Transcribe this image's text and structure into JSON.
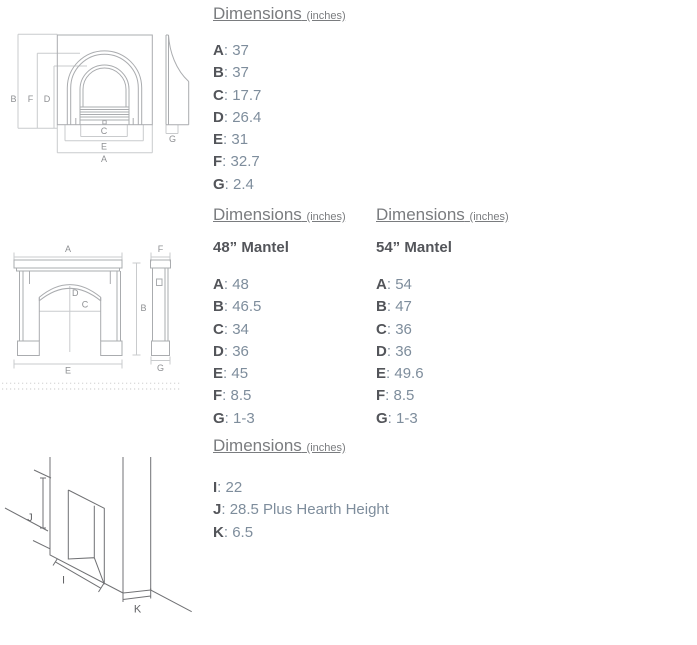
{
  "punct": {
    "colon": ": "
  },
  "headings": {
    "dimensions_title": "Dimensions",
    "dimensions_unit": "(inches)"
  },
  "insert": {
    "dims": [
      {
        "label": "A",
        "value": "37"
      },
      {
        "label": "B",
        "value": "37"
      },
      {
        "label": "C",
        "value": "17.7"
      },
      {
        "label": "D",
        "value": "26.4"
      },
      {
        "label": "E",
        "value": "31"
      },
      {
        "label": "F",
        "value": "32.7"
      },
      {
        "label": "G",
        "value": "2.4"
      }
    ]
  },
  "mantel48": {
    "subtitle": "48” Mantel",
    "dims": [
      {
        "label": "A",
        "value": "48"
      },
      {
        "label": "B",
        "value": "46.5"
      },
      {
        "label": "C",
        "value": "34"
      },
      {
        "label": "D",
        "value": "36"
      },
      {
        "label": "E",
        "value": "45"
      },
      {
        "label": "F",
        "value": "8.5"
      },
      {
        "label": "G",
        "value": "1-3"
      }
    ]
  },
  "mantel54": {
    "subtitle": "54” Mantel",
    "dims": [
      {
        "label": "A",
        "value": "54"
      },
      {
        "label": "B",
        "value": "47"
      },
      {
        "label": "C",
        "value": "36"
      },
      {
        "label": "D",
        "value": "36"
      },
      {
        "label": "E",
        "value": "49.6"
      },
      {
        "label": "F",
        "value": "8.5"
      },
      {
        "label": "G",
        "value": "1-3"
      }
    ]
  },
  "opening": {
    "dims": [
      {
        "label": "I",
        "value": "22"
      },
      {
        "label": "J",
        "value": "28.5 Plus Hearth Height"
      },
      {
        "label": "K",
        "value": "6.5"
      }
    ]
  },
  "drawing_labels": {
    "a": "A",
    "b": "B",
    "c": "C",
    "d": "D",
    "e": "E",
    "f": "F",
    "g": "G",
    "i": "I",
    "j": "J",
    "k": "K"
  },
  "colors": {
    "background": "#ffffff",
    "heading_text": "#7a7c7f",
    "dim_label_text": "#53555a",
    "dim_value_text": "#7e8d9c",
    "drawing_line_light": "#aaacaf",
    "dimension_line": "#c9cbcd",
    "drawing_line_dark": "#707174"
  }
}
